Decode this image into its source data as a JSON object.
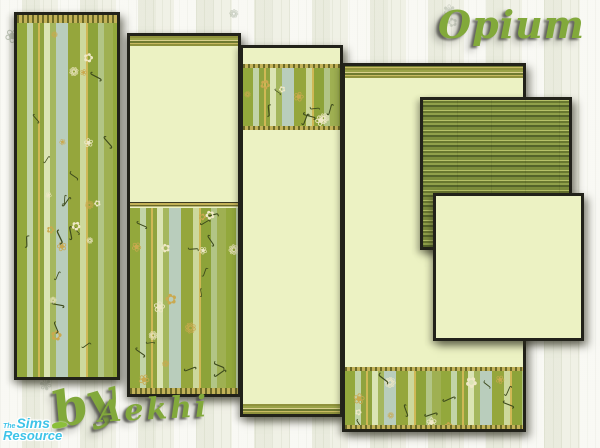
{
  "page": {
    "title": "Opium",
    "byline_prefix": "by",
    "artist": "Aekhi"
  },
  "logo": {
    "the": "The",
    "sims": "Sims",
    "resource": "Resource"
  },
  "panels": [
    {
      "id": "p1",
      "kind": "full-striped-floral-wallpaper"
    },
    {
      "id": "p2",
      "kind": "wainscot-cream-top-floral-bottom"
    },
    {
      "id": "p3",
      "kind": "cream-with-floral-border-near-top"
    },
    {
      "id": "p4",
      "kind": "cream-with-floral-border-at-bottom"
    },
    {
      "id": "p5",
      "kind": "horizontal-stripe-texture-swatch"
    },
    {
      "id": "p6",
      "kind": "plain-cream-swatch"
    }
  ],
  "colors": {
    "accent_green": "#82a93b",
    "cream": "#ecf2c3",
    "dark_border": "#22221a",
    "gold_trim": "#c3b258",
    "logo_blue": "#3fc4e8",
    "stripe_palette": [
      "#93a83c",
      "#c2d4a8",
      "#8fa33e",
      "#dbe4b4",
      "#a5b75e",
      "#b9cdbc",
      "#cdd89c",
      "#8da339"
    ],
    "hstripe_palette": [
      "#55642a",
      "#90a04a",
      "#68772f",
      "#b5c068",
      "#7c8c3c"
    ]
  },
  "decor": {
    "vines": {
      "glyphs": [
        "∫",
        "✿",
        "ʃ",
        "❀",
        "∫",
        "❁"
      ],
      "colors": [
        "#3d4a1c",
        "#efe8c6",
        "#3d4a1c",
        "#caa94f"
      ],
      "min": 8,
      "max": 15
    },
    "doodles": {
      "glyphs": [
        "❀",
        "✿",
        "❁",
        "✾"
      ],
      "colors": [
        "rgba(148,160,138,0.55)",
        "rgba(160,170,152,0.42)"
      ],
      "min": 11,
      "max": 19
    }
  }
}
